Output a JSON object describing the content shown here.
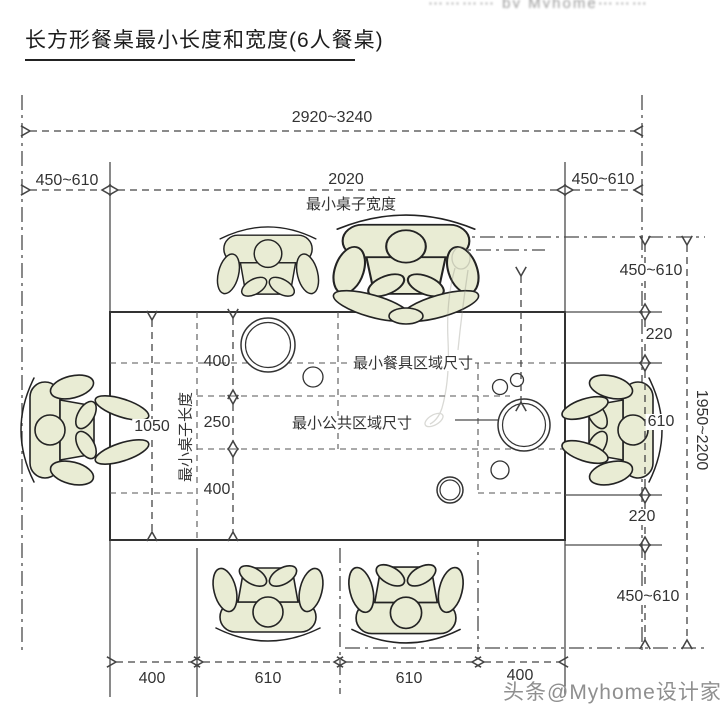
{
  "title": "长方形餐桌最小长度和宽度(6人餐桌)",
  "watermarks": {
    "top": "⋯⋯⋯⋯ by Myhome⋯⋯⋯",
    "bottom": "头条@Myhome设计家"
  },
  "dims": {
    "overall_width": "2920~3240",
    "left_clearance": "450~610",
    "table_width": "2020",
    "table_width_label": "最小桌子宽度",
    "right_clearance": "450~610",
    "table_length": "1050",
    "table_length_label": "最小桌子长度",
    "inner": [
      "400",
      "250",
      "400"
    ],
    "right_chain": [
      "450~610",
      "220",
      "610",
      "220",
      "450~610"
    ],
    "overall_depth": "1950~2200",
    "bottom_chain": [
      "400",
      "610",
      "610",
      "400"
    ],
    "dish_area_label": "最小餐具区域尺寸",
    "common_area_label": "最小公共区域尺寸"
  }
}
